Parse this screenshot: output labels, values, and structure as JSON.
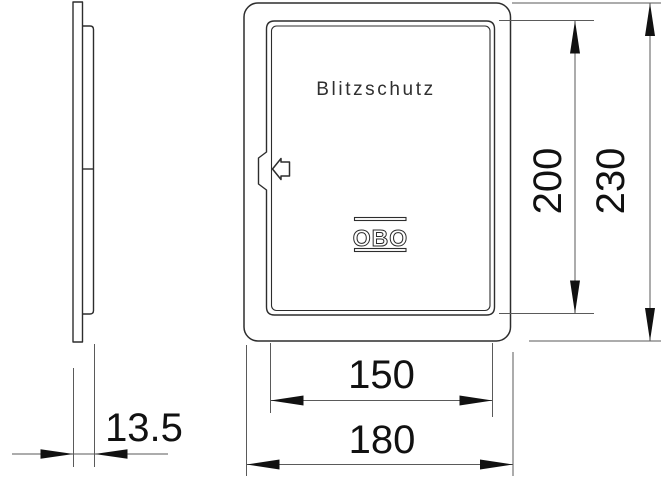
{
  "front_view": {
    "door_label": "Blitzschutz",
    "brand_label": "OBO"
  },
  "dimensions": {
    "door_height": "200",
    "overall_height": "230",
    "door_width": "150",
    "overall_width": "180",
    "depth": "13.5"
  },
  "colors": {
    "background": "#ffffff",
    "object_line": "#2d2d2d",
    "dimension_line": "#5a5a5a",
    "dimension_text": "#111111",
    "engraved_text": "#2f2f2f"
  }
}
